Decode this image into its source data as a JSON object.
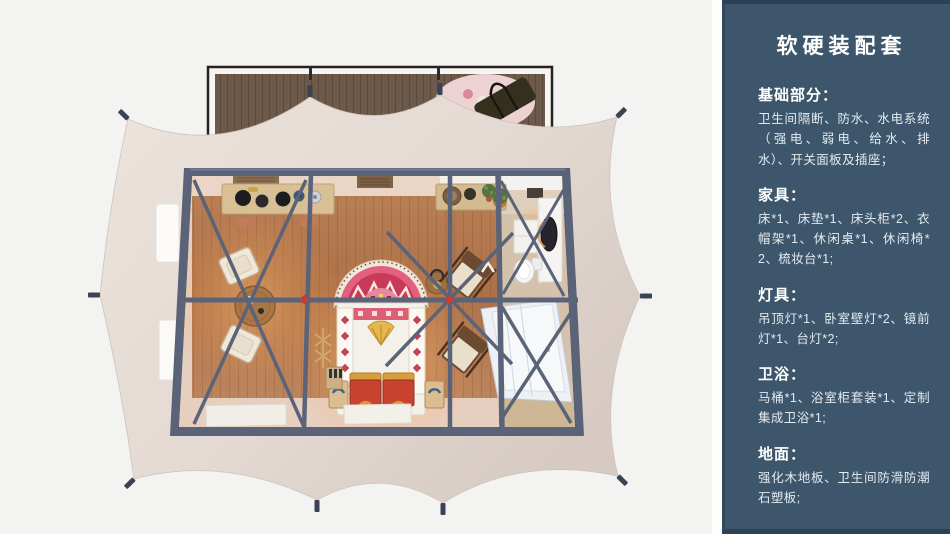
{
  "panel": {
    "title": "软硬装配套",
    "sections": [
      {
        "heading": "基础部分：",
        "body": "卫生间隔断、防水、水电系统（强电、弱电、给水、排水）、开关面板及插座；"
      },
      {
        "heading": "家具：",
        "body": "床*1、床垫*1、床头柜*2、衣帽架*1、休闲桌*1、休闲椅*2、梳妆台*1;"
      },
      {
        "heading": "灯具：",
        "body": "吊顶灯*1、卧室壁灯*2、镜前灯*1、台灯*2;"
      },
      {
        "heading": "卫浴：",
        "body": "马桶*1、浴室柜套装*1、定制集成卫浴*1;"
      },
      {
        "heading": "地面：",
        "body": "强化木地板、卫生间防滑防潮石塑板;"
      }
    ],
    "colors": {
      "panel_bg": "#3d566b",
      "panel_border": "#2b4254",
      "heading_text": "#ffffff",
      "body_text": "#e4ebf1"
    }
  },
  "illustration": {
    "alt": "帐篷客房顶视 3D 渲染图：木地板卧室、休闲区、梳妆与集成卫浴布局，米色帐篷篷布与深蓝钢架",
    "colors": {
      "background": "#f3f3f2",
      "tent_canvas": "#e7ddd6",
      "steel_frame": "#5a6378",
      "wood_floor": "#b37a52",
      "deck_wood": "#6e5a4b",
      "accent_red": "#c7432f"
    }
  }
}
